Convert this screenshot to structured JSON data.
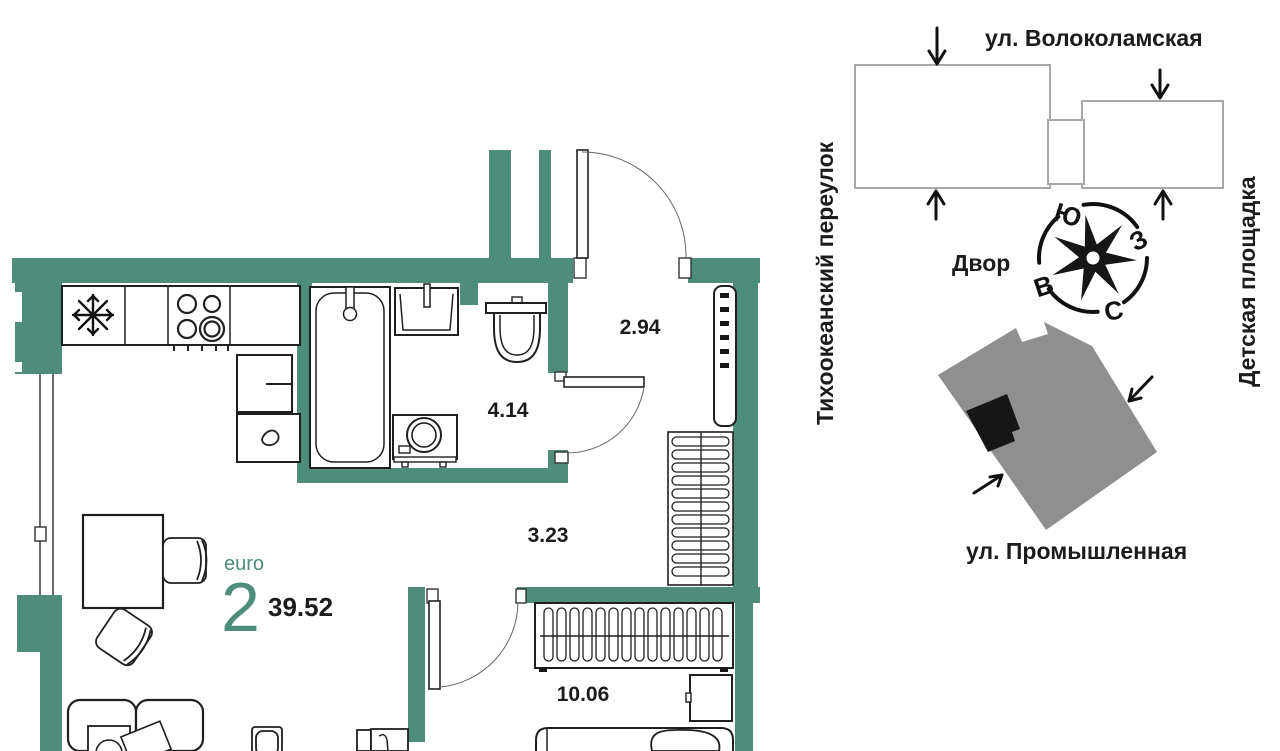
{
  "plan": {
    "unit_format_label": "euro",
    "rooms_count": "2",
    "total_area_m2": "39.52",
    "areas": {
      "hallway_m2": "2.94",
      "bathroom_m2": "4.14",
      "corridor_m2": "3.23",
      "bedroom_m2": "10.06"
    }
  },
  "site_plan": {
    "street_top": "ул. Волоколамская",
    "street_left": "Тихоокеанский переулок",
    "area_right": "Детская площадка",
    "courtyard_label": "Двор",
    "street_bottom": "ул. Промышленная",
    "compass": {
      "north": "С",
      "south": "Ю",
      "east": "В",
      "west": "З"
    }
  },
  "colors": {
    "wall_teal": "#4e8c7c",
    "site_building_gray": "#8f8f8f",
    "unit_marker_black": "#161616",
    "building_outline_gray": "#a8a8a8"
  }
}
